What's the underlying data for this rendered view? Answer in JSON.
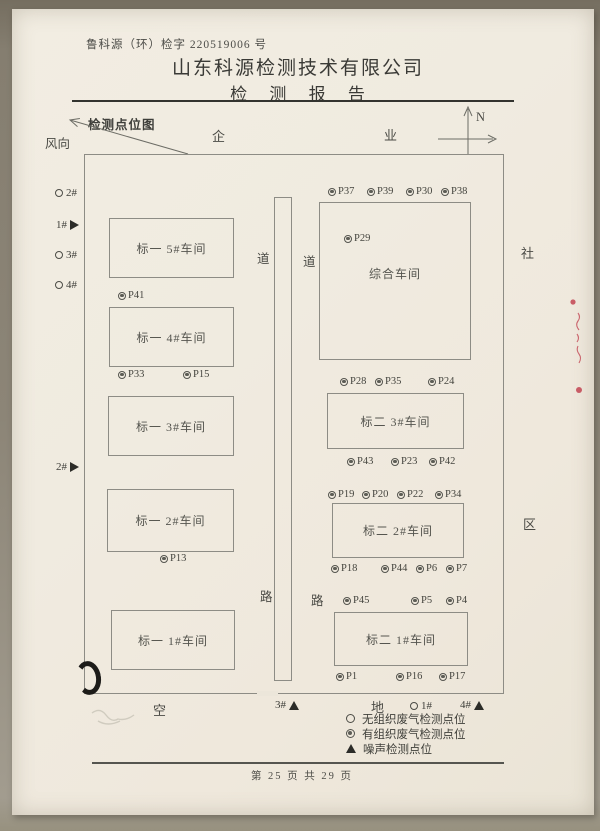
{
  "header": {
    "doc_number": "鲁科源（环）检字 220519006 号",
    "company_name": "山东科源检测技术有限公司",
    "report_title": "检 测 报 告"
  },
  "map": {
    "title": "检测点位图",
    "wind_label": "风向",
    "compass_north": "N",
    "surroundings": {
      "top_left": "企",
      "top_right": "业",
      "right_upper": "社",
      "right_lower": "区",
      "bottom_left": "空",
      "bottom_right": "地"
    },
    "road_labels": {
      "upper_left": "道",
      "upper_right": "道",
      "lower_left": "路",
      "lower_right": "路"
    },
    "buildings": [
      "标一 5#车间",
      "标一 4#车间",
      "标一 3#车间",
      "标一 2#车间",
      "标一 1#车间",
      "综合车间",
      "标二 3#车间",
      "标二 2#车间",
      "标二 1#车间"
    ],
    "points": [
      "P41",
      "P33",
      "P15",
      "P13",
      "P37",
      "P39",
      "P30",
      "P38",
      "P29",
      "P28",
      "P35",
      "P24",
      "P43",
      "P23",
      "P42",
      "P19",
      "P20",
      "P22",
      "P34",
      "P18",
      "P44",
      "P6",
      "P7",
      "P45",
      "P5",
      "P4",
      "P1",
      "P16",
      "P17"
    ],
    "left_markers": [
      {
        "type": "circle",
        "label": "2#"
      },
      {
        "type": "triangle-right",
        "label": "1#"
      },
      {
        "type": "circle",
        "label": "3#"
      },
      {
        "type": "circle",
        "label": "4#"
      },
      {
        "type": "triangle-right",
        "label": "2#"
      }
    ],
    "bottom_markers": [
      {
        "type": "triangle-up",
        "label": "3#"
      },
      {
        "type": "circle",
        "label": "1#"
      },
      {
        "type": "triangle-up",
        "label": "4#"
      }
    ]
  },
  "legend": {
    "items": [
      {
        "symbol": "open-circle",
        "label": "无组织废气检测点位"
      },
      {
        "symbol": "double-circle",
        "label": "有组织废气检测点位"
      },
      {
        "symbol": "filled-triangle",
        "label": "噪声检测点位"
      }
    ]
  },
  "footer": {
    "page_info": "第 25 页 共 29 页"
  },
  "colors": {
    "paper": "#f0ebe0",
    "line": "#8d8c85",
    "ink": "#3a3a36",
    "red_ink": "#bf3a48"
  }
}
